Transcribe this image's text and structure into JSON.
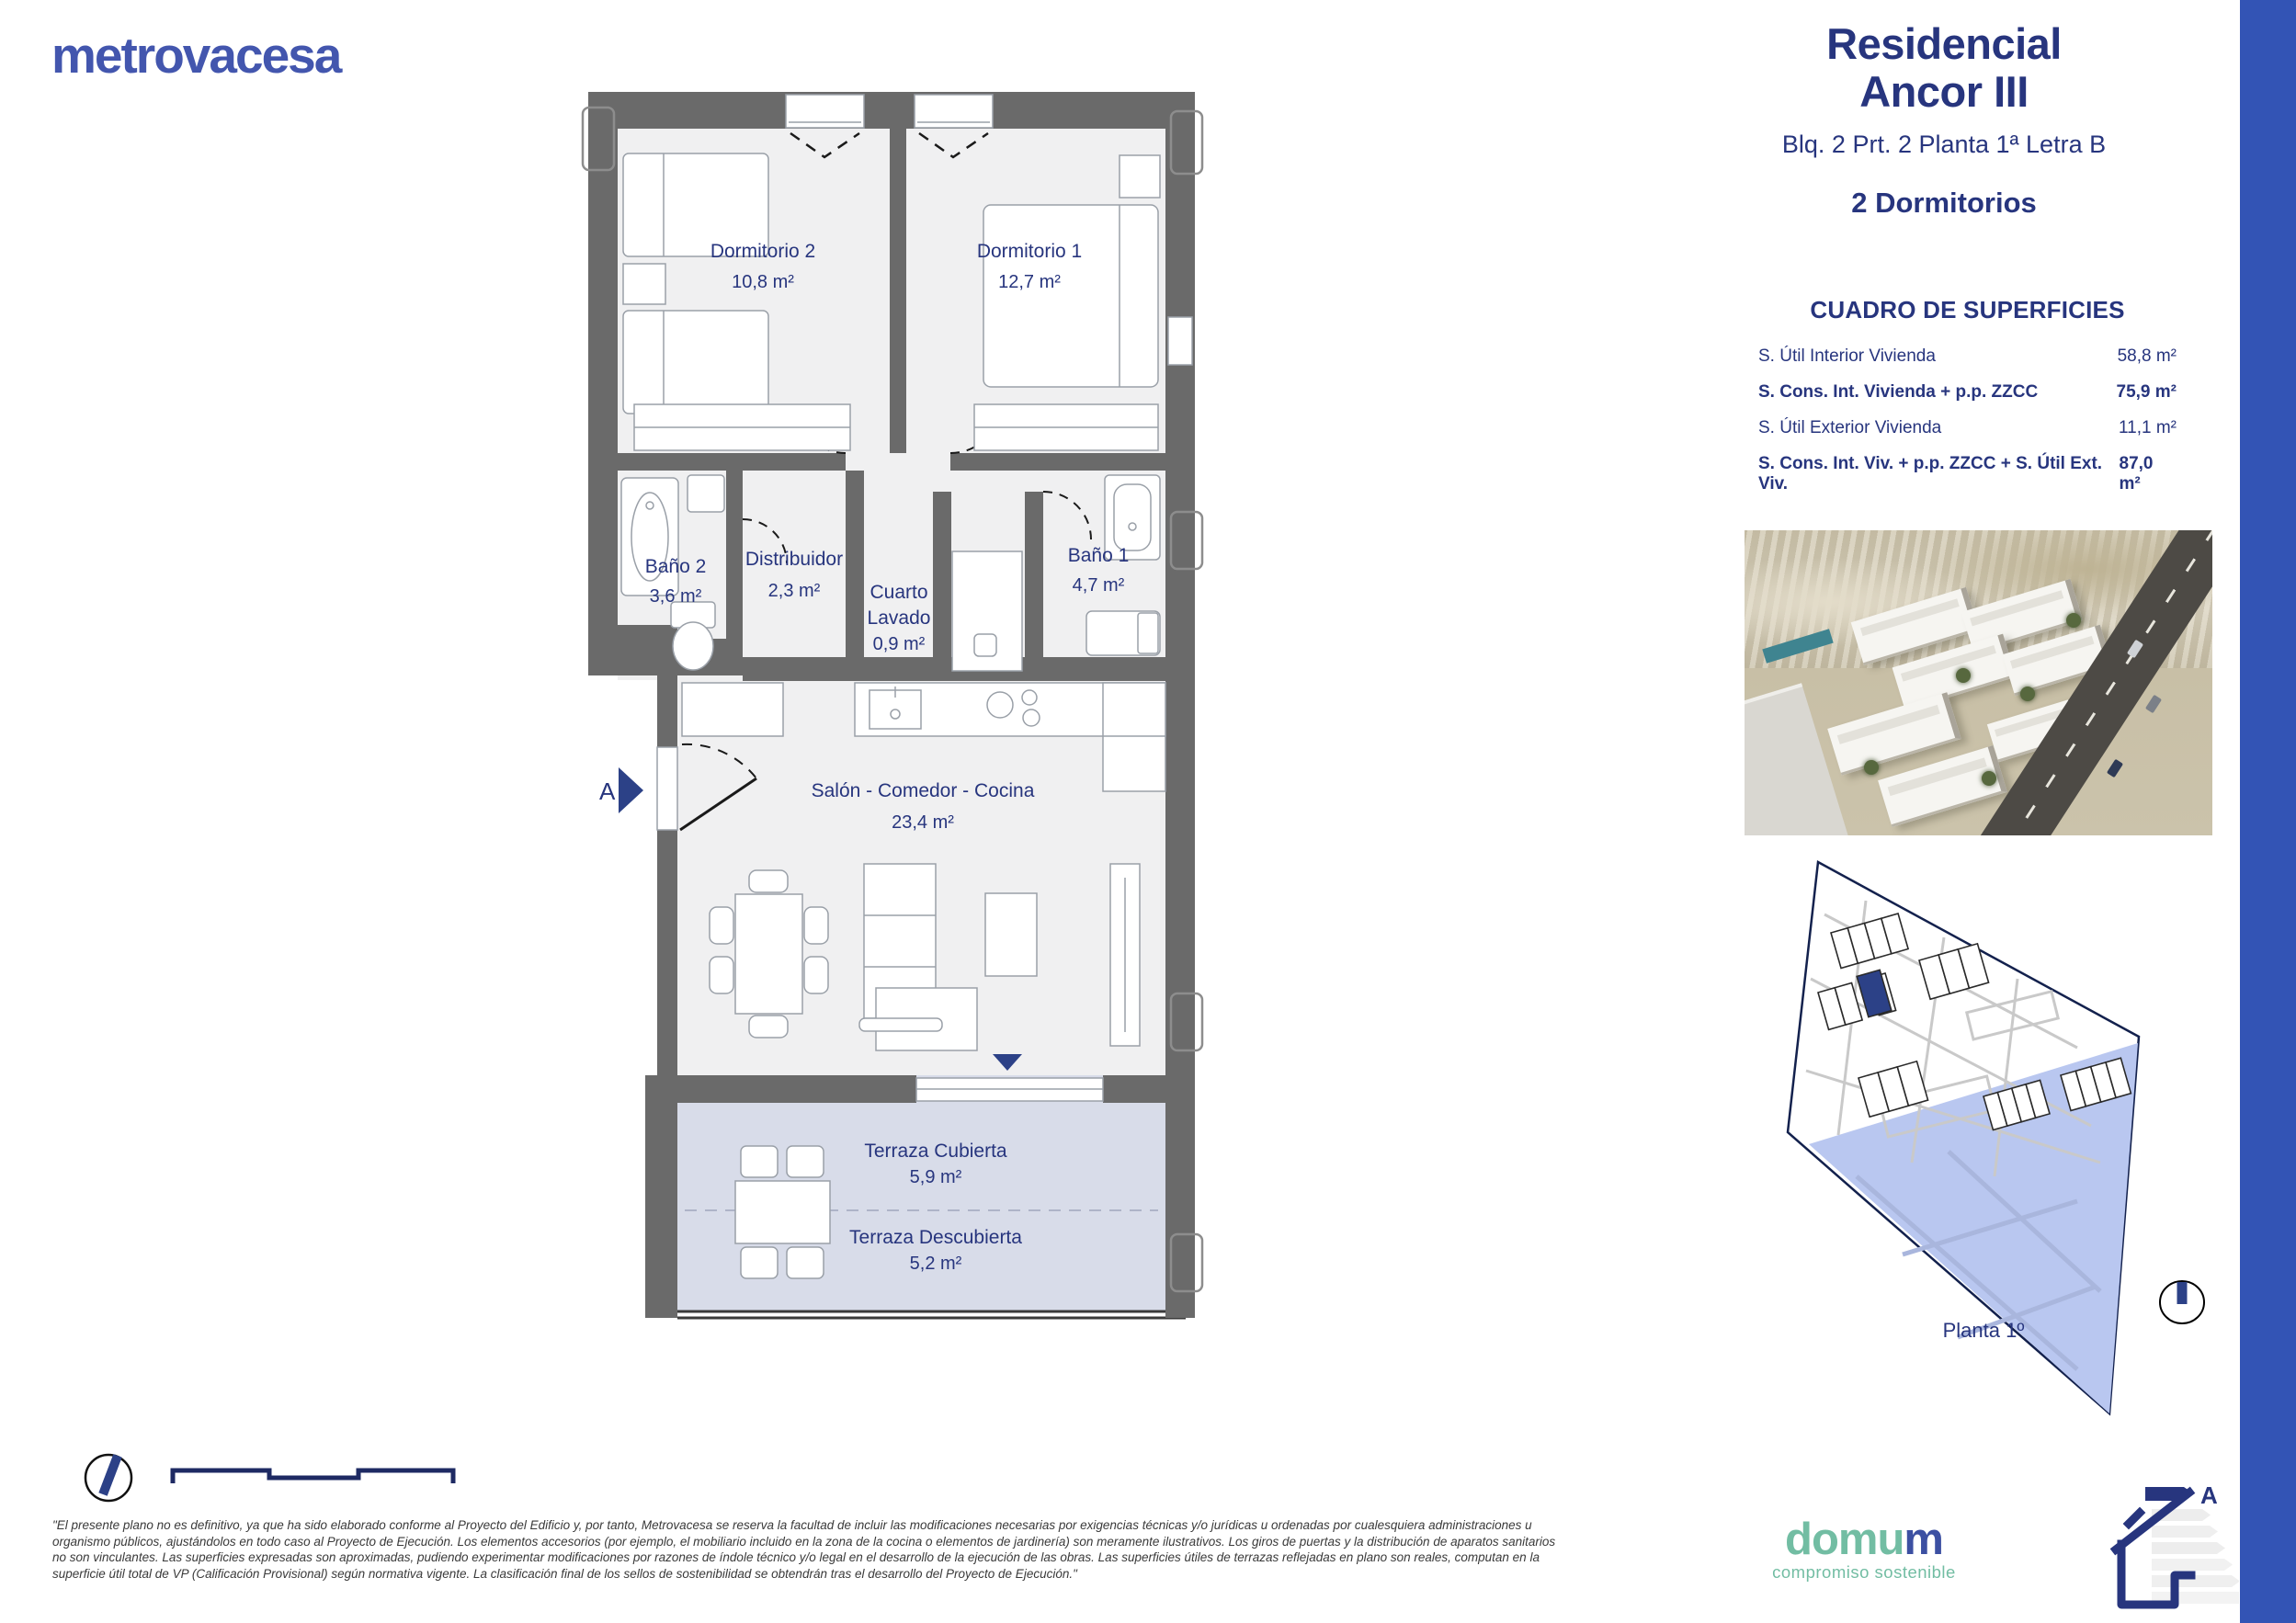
{
  "brand": {
    "name": "metrovacesa"
  },
  "header": {
    "title_line1": "Residencial",
    "title_line2": "Ancor III",
    "subtitle": "Blq. 2 Prt. 2 Planta 1ª Letra B",
    "rooms_count": "2 Dormitorios"
  },
  "surfaces": {
    "title": "CUADRO DE SUPERFICIES",
    "rows": [
      {
        "label": "S. Útil Interior Vivienda",
        "value": "58,8 m²"
      },
      {
        "label": "S. Cons. Int. Vivienda + p.p. ZZCC",
        "value": "75,9 m²"
      },
      {
        "label": "S. Útil Exterior Vivienda",
        "value": "11,1 m²"
      },
      {
        "label": "S. Cons. Int. Viv. + p.p. ZZCC + S. Útil Ext. Viv.",
        "value": "87,0 m²"
      }
    ]
  },
  "floorplan": {
    "section_marker": "A",
    "rooms": {
      "dormitorio2": {
        "name": "Dormitorio 2",
        "area": "10,8 m²"
      },
      "dormitorio1": {
        "name": "Dormitorio 1",
        "area": "12,7 m²"
      },
      "bano2": {
        "name": "Baño 2",
        "area": "3,6 m²"
      },
      "distribuidor": {
        "name": "Distribuidor",
        "area": "2,3 m²"
      },
      "cuarto_lavado": {
        "name_line1": "Cuarto",
        "name_line2": "Lavado",
        "area": "0,9 m²"
      },
      "bano1": {
        "name": "Baño 1",
        "area": "4,7 m²"
      },
      "salon": {
        "name": "Salón - Comedor - Cocina",
        "area": "23,4 m²"
      },
      "terraza_cubierta": {
        "name": "Terraza Cubierta",
        "area": "5,9 m²"
      },
      "terraza_descubierta": {
        "name": "Terraza Descubierta",
        "area": "5,2 m²"
      }
    }
  },
  "siteplan": {
    "caption": "Planta 1º"
  },
  "energy_icon": {
    "rating": "A"
  },
  "footer": {
    "domum_part1": "domu",
    "domum_part2": "m",
    "domum_tagline": "compromiso sostenible",
    "disclaimer_lines": [
      "\"El presente plano no es definitivo, ya que ha sido elaborado conforme al Proyecto del Edificio y, por tanto, Metrovacesa se reserva la facultad de incluir las modificaciones necesarias por exigencias técnicas y/o jurídicas u ordenadas por cualesquiera administraciones u",
      "organismo públicos, ajustándolos en todo caso al Proyecto de Ejecución. Los elementos accesorios (por ejemplo, el mobiliario incluido en la zona de la cocina o elementos de jardinería) son meramente ilustrativos. Los giros de puertas y la distribución de aparatos sanitarios",
      "no son vinculantes. Las superficies expresadas son aproximadas, pudiendo experimentar modificaciones por razones de índole técnico y/o legal en el desarrollo de la ejecución de las obras. Las superficies útiles de terrazas reflejadas en plano son reales, computan en la",
      "superficie útil total de VP (Calificación Provisional) según normativa vigente. La clasificación final de los sellos de sostenibilidad se obtendrán tras el desarrollo del Proyecto de Ejecución.\""
    ]
  },
  "colors": {
    "navy_text": "#27357e",
    "side_bar_blue": "#3354b5",
    "logo_blue": "#4356ae",
    "wall_gray": "#6a6a6a",
    "room_fill": "#f0f0f1",
    "terrace_fill": "#d8dce9",
    "siteplan_water_blue": "#b9c7f0",
    "domum_teal": "#72bda3",
    "highlight_unit_navy": "#2c4187"
  }
}
